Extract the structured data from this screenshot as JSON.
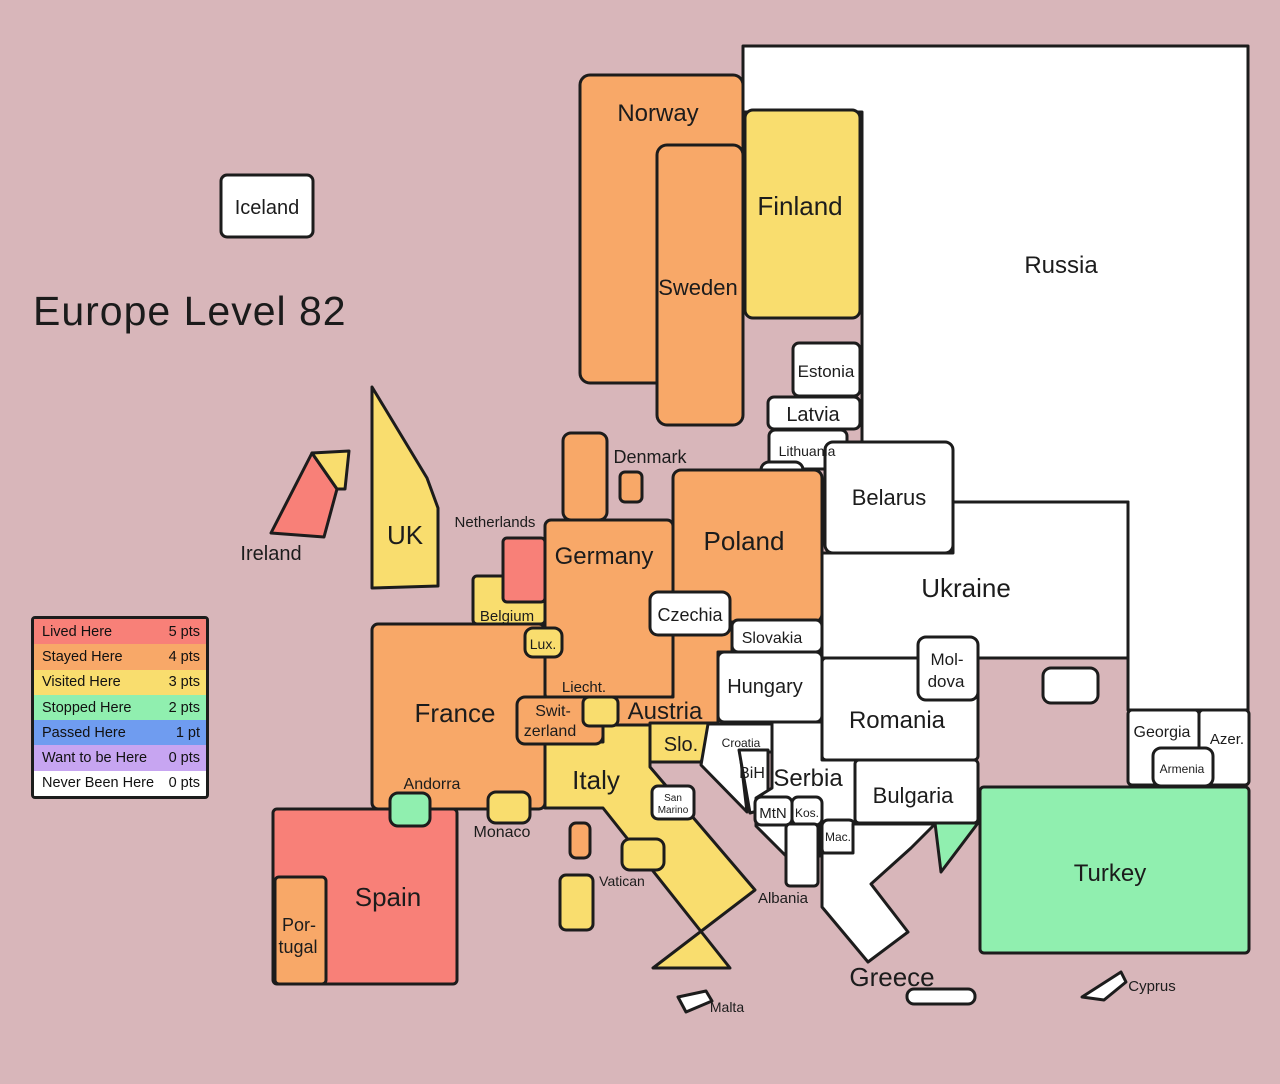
{
  "title": "Europe Level 82",
  "palette": {
    "background": "#D8B6BA",
    "border": "#1C1C1C",
    "lived": "#F88078",
    "stayed": "#F8A868",
    "visited": "#F9DD6E",
    "stopped": "#90EFAF",
    "passed": "#6F9CF0",
    "want": "#C7A5F1",
    "never": "#FFFFFF"
  },
  "legend": {
    "items": [
      {
        "label": "Lived Here",
        "points": "5 pts",
        "key": "lived",
        "color": "#F88078"
      },
      {
        "label": "Stayed Here",
        "points": "4 pts",
        "key": "stayed",
        "color": "#F8A868"
      },
      {
        "label": "Visited Here",
        "points": "3 pts",
        "key": "visited",
        "color": "#F9DD6E"
      },
      {
        "label": "Stopped Here",
        "points": "2 pts",
        "key": "stopped",
        "color": "#90EFAF"
      },
      {
        "label": "Passed Here",
        "points": "1 pt",
        "key": "passed",
        "color": "#6F9CF0"
      },
      {
        "label": "Want to be Here",
        "points": "0 pts",
        "key": "want",
        "color": "#C7A5F1"
      },
      {
        "label": "Never Been Here",
        "points": "0 pts",
        "key": "never",
        "color": "#FFFFFF"
      }
    ]
  },
  "countries": {
    "iceland": {
      "label": "Iceland",
      "level": "never"
    },
    "norway": {
      "label": "Norway",
      "level": "stayed"
    },
    "sweden": {
      "label": "Sweden",
      "level": "stayed"
    },
    "finland": {
      "label": "Finland",
      "level": "visited"
    },
    "russia": {
      "label": "Russia",
      "level": "never"
    },
    "estonia": {
      "label": "Estonia",
      "level": "never"
    },
    "latvia": {
      "label": "Latvia",
      "level": "never"
    },
    "lithuania": {
      "label": "Lithuania",
      "level": "never"
    },
    "kaliningrad": {
      "level": "never"
    },
    "belarus": {
      "label": "Belarus",
      "level": "never"
    },
    "ukraine": {
      "label": "Ukraine",
      "level": "never"
    },
    "crimea": {
      "level": "never"
    },
    "denmark": {
      "label": "Denmark",
      "level": "stayed"
    },
    "poland": {
      "label": "Poland",
      "level": "stayed"
    },
    "germany": {
      "label": "Germany",
      "level": "stayed"
    },
    "netherlands": {
      "label": "Netherlands",
      "level": "lived"
    },
    "belgium": {
      "label": "Belgium",
      "level": "visited"
    },
    "luxembourg": {
      "label": "Lux.",
      "level": "visited"
    },
    "czechia": {
      "label": "Czechia",
      "level": "never"
    },
    "slovakia": {
      "label": "Slovakia",
      "level": "never"
    },
    "hungary": {
      "label": "Hungary",
      "level": "never"
    },
    "france": {
      "label": "France",
      "level": "stayed"
    },
    "switzerland": {
      "line1": "Swit-",
      "line2": "zerland",
      "level": "stayed"
    },
    "liechtenstein": {
      "label": "Liecht.",
      "level": "visited"
    },
    "austria": {
      "label": "Austria",
      "level": "stayed"
    },
    "italy": {
      "label": "Italy",
      "level": "visited"
    },
    "slovenia": {
      "label": "Slo.",
      "level": "visited"
    },
    "croatia": {
      "label": "Croatia",
      "level": "never"
    },
    "bih": {
      "label": "BiH",
      "level": "never"
    },
    "serbia": {
      "label": "Serbia",
      "level": "never"
    },
    "montenegro": {
      "label": "MtN",
      "level": "never"
    },
    "kosovo": {
      "label": "Kos.",
      "level": "never"
    },
    "macedonia": {
      "label": "Mac.",
      "level": "never"
    },
    "albania": {
      "label": "Albania",
      "level": "never"
    },
    "romania": {
      "label": "Romania",
      "level": "never"
    },
    "moldova": {
      "line1": "Mol-",
      "line2": "dova",
      "level": "never"
    },
    "bulgaria": {
      "label": "Bulgaria",
      "level": "never"
    },
    "greece": {
      "label": "Greece",
      "level": "never"
    },
    "crete": {
      "level": "never"
    },
    "turkey": {
      "label": "Turkey",
      "level": "stopped"
    },
    "turkey_thrace": {
      "level": "stopped"
    },
    "georgia": {
      "label": "Georgia",
      "level": "never"
    },
    "armenia": {
      "label": "Armenia",
      "level": "never"
    },
    "azerbaijan": {
      "label": "Azer.",
      "level": "never"
    },
    "cyprus": {
      "label": "Cyprus",
      "level": "never"
    },
    "malta": {
      "label": "Malta",
      "level": "never"
    },
    "spain": {
      "label": "Spain",
      "level": "lived"
    },
    "portugal": {
      "line1": "Por-",
      "line2": "tugal",
      "level": "stayed"
    },
    "andorra": {
      "label": "Andorra",
      "level": "stopped"
    },
    "monaco": {
      "label": "Monaco",
      "level": "visited"
    },
    "corsica": {
      "level": "stayed"
    },
    "sardinia": {
      "level": "visited"
    },
    "vatican": {
      "label": "Vatican",
      "level": "visited"
    },
    "san_marino": {
      "line1": "San",
      "line2": "Marino",
      "level": "never"
    },
    "uk": {
      "label": "UK",
      "level": "visited"
    },
    "northern_ireland": {
      "level": "visited"
    },
    "ireland": {
      "label": "Ireland",
      "level": "lived"
    }
  }
}
